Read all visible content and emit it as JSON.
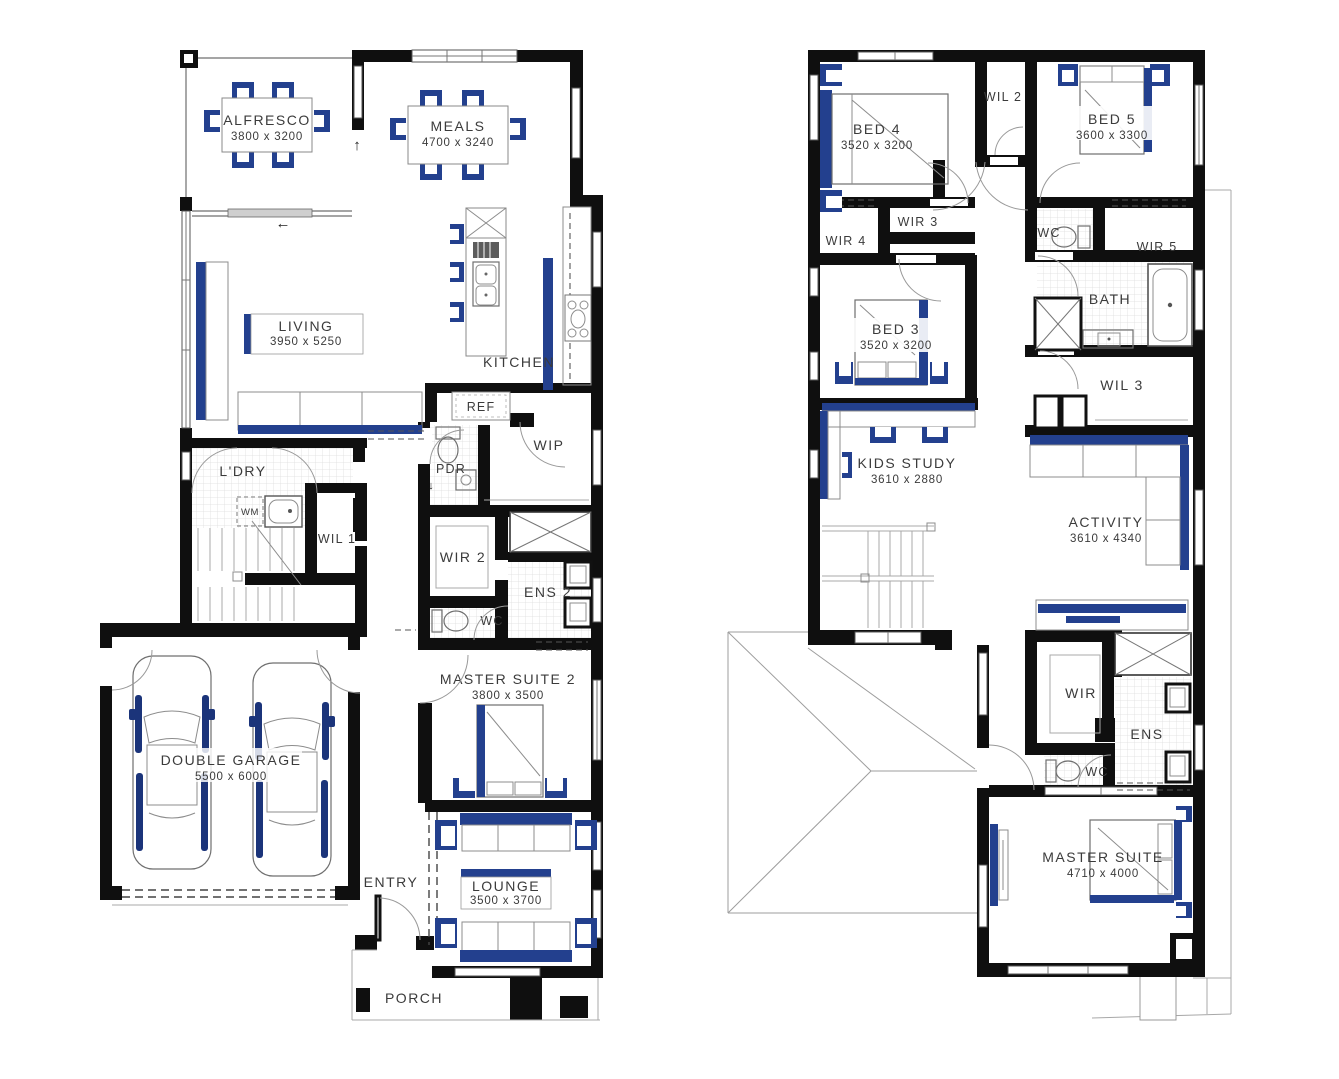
{
  "colors": {
    "wall": "#0f0f0f",
    "accent_blue": "#23408e",
    "accent_blue_dark": "#1b347a",
    "line_gray": "#8c8c8c",
    "text": "#3b3b3b"
  },
  "arrows": {
    "up": "↑",
    "left": "←",
    "down": "↓"
  },
  "ground_floor": {
    "alfresco": {
      "name": "ALFRESCO",
      "dims": "3800 x 3200"
    },
    "meals": {
      "name": "MEALS",
      "dims": "4700 x 3240"
    },
    "living": {
      "name": "LIVING",
      "dims": "3950 x 5250"
    },
    "kitchen": {
      "name": "KITCHEN"
    },
    "ref": {
      "name": "REF"
    },
    "wip": {
      "name": "WIP"
    },
    "pdr": {
      "name": "PDR"
    },
    "ldry": {
      "name": "L'DRY"
    },
    "wm": {
      "name": "WM"
    },
    "wil1": {
      "name": "WIL 1"
    },
    "wir2": {
      "name": "WIR 2"
    },
    "ens2": {
      "name": "ENS 2"
    },
    "wc": {
      "name": "WC"
    },
    "master_suite_2": {
      "name": "MASTER SUITE 2",
      "dims": "3800 x 3500"
    },
    "double_garage": {
      "name": "DOUBLE GARAGE",
      "dims": "5500 x 6000"
    },
    "entry": {
      "name": "ENTRY"
    },
    "lounge": {
      "name": "LOUNGE",
      "dims": "3500 x 3700"
    },
    "porch": {
      "name": "PORCH"
    }
  },
  "first_floor": {
    "bed4": {
      "name": "BED 4",
      "dims": "3520 x 3200"
    },
    "wil2": {
      "name": "WIL 2"
    },
    "bed5": {
      "name": "BED 5",
      "dims": "3600 x 3300"
    },
    "wir4": {
      "name": "WIR 4"
    },
    "wir3": {
      "name": "WIR 3"
    },
    "wc_upper": {
      "name": "WC"
    },
    "wir5": {
      "name": "WIR 5"
    },
    "bath": {
      "name": "BATH"
    },
    "bed3": {
      "name": "BED 3",
      "dims": "3520 x 3200"
    },
    "wil3": {
      "name": "WIL 3"
    },
    "kids_study": {
      "name": "KIDS STUDY",
      "dims": "3610 x 2880"
    },
    "activity": {
      "name": "ACTIVITY",
      "dims": "3610 x 4340"
    },
    "wir": {
      "name": "WIR"
    },
    "ens": {
      "name": "ENS"
    },
    "wc_master": {
      "name": "WC"
    },
    "master_suite": {
      "name": "MASTER SUITE",
      "dims": "4710 x 4000"
    }
  }
}
